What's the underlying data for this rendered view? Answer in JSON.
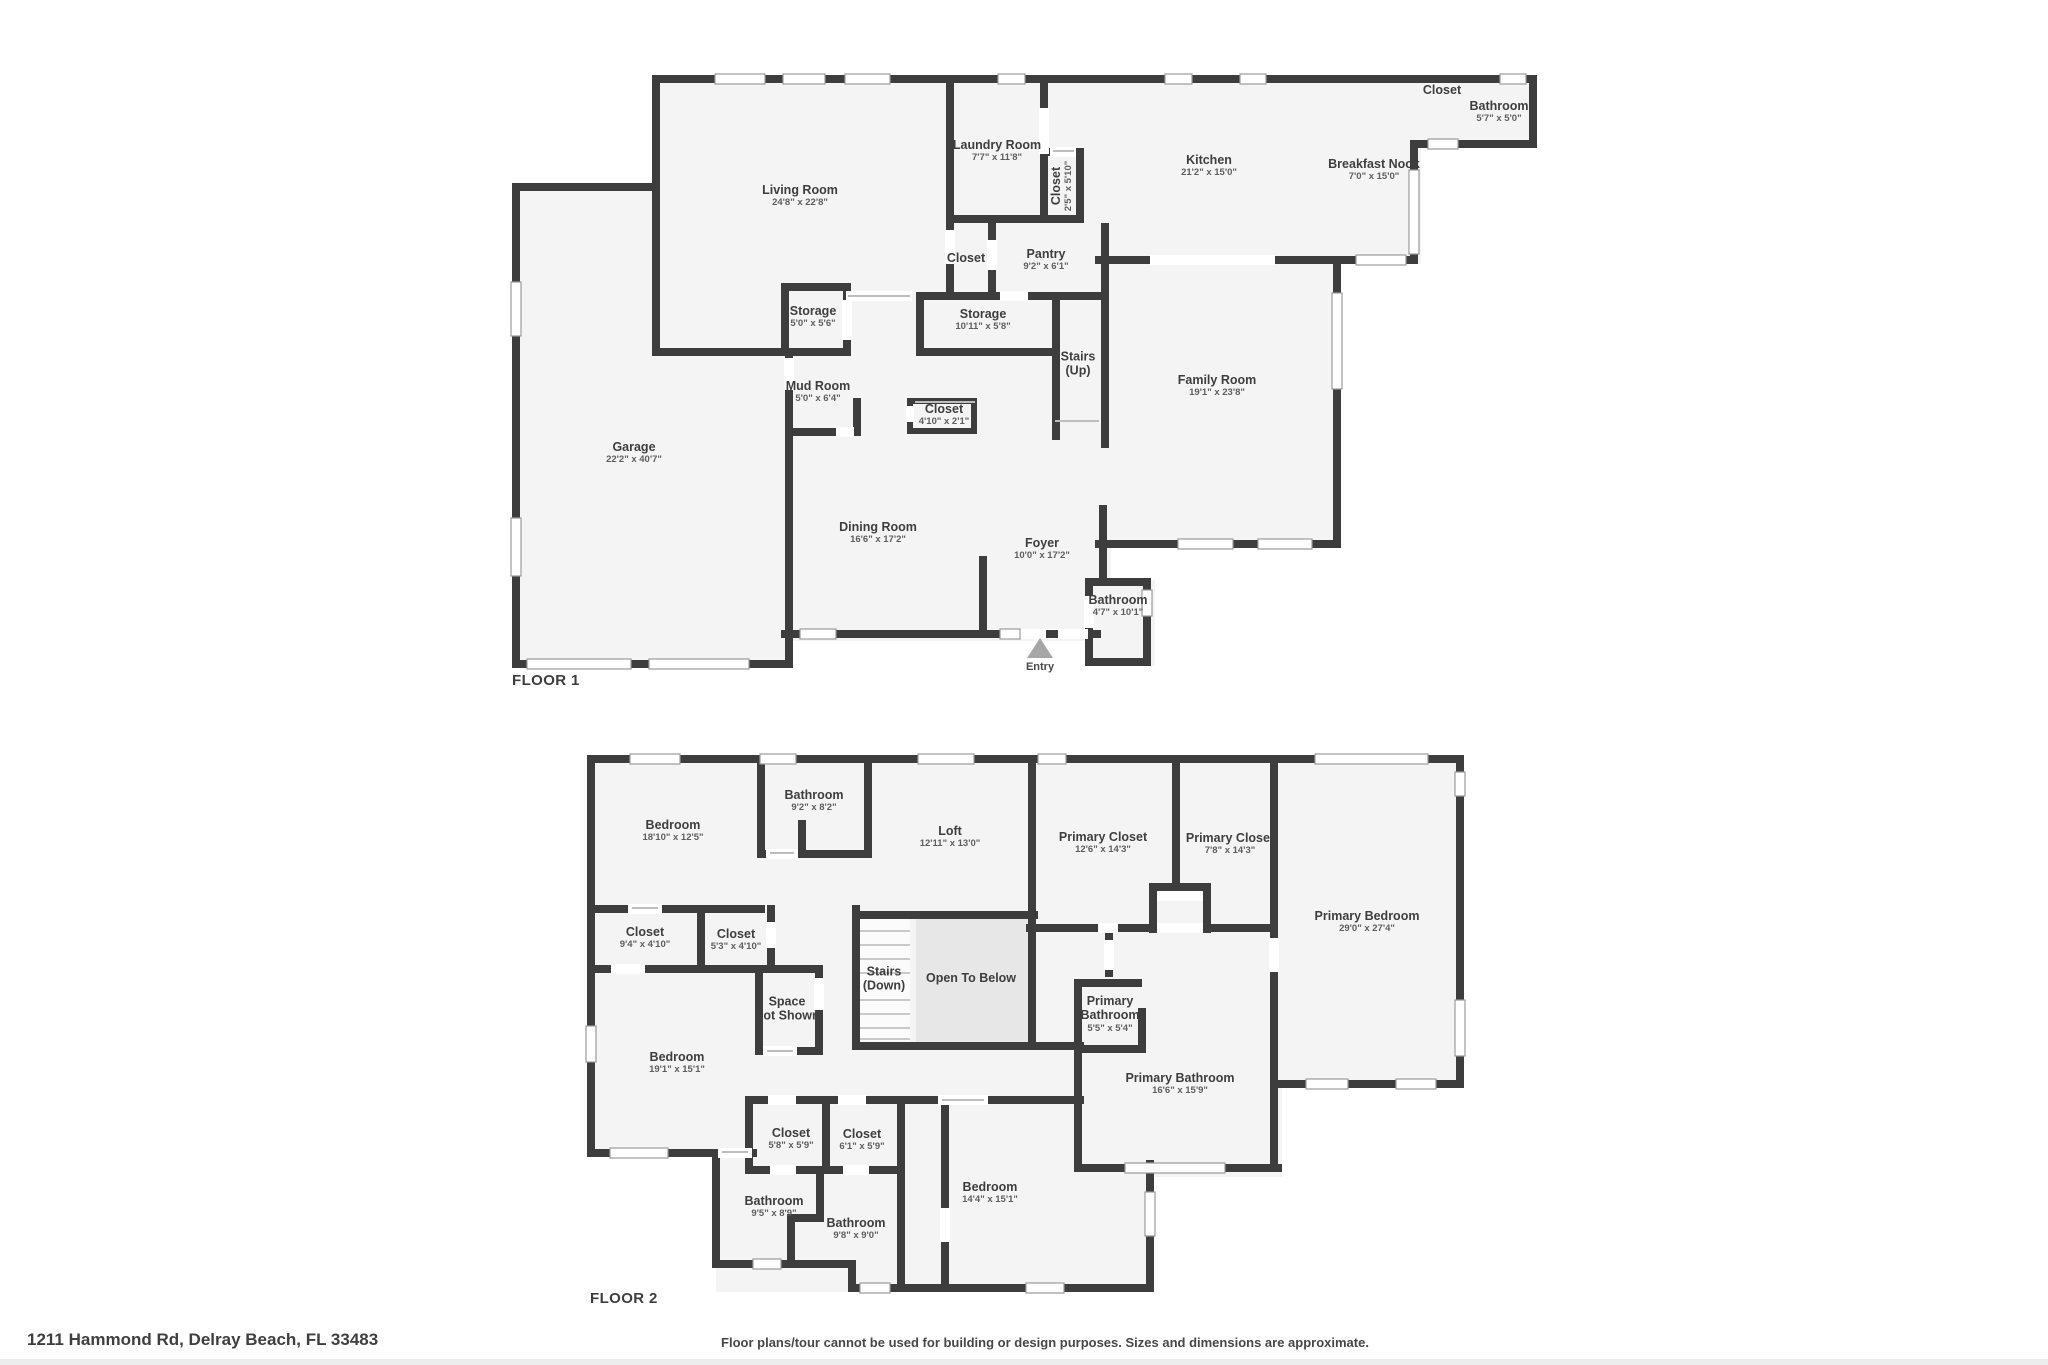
{
  "floor1": {
    "label": "FLOOR 1",
    "entry_label": "Entry",
    "rooms": [
      {
        "name": "Living Room",
        "dims": "24'8\" x 22'8\""
      },
      {
        "name": "Laundry Room",
        "dims": "7'7\" x 11'8\""
      },
      {
        "name": "Closet",
        "dims": "2'5\" x 5'10\""
      },
      {
        "name": "Closet",
        "dims": ""
      },
      {
        "name": "Pantry",
        "dims": "9'2\" x 6'1\""
      },
      {
        "name": "Kitchen",
        "dims": "21'2\" x 15'0\""
      },
      {
        "name": "Breakfast Nook",
        "dims": "7'0\" x 15'0\""
      },
      {
        "name": "Closet",
        "dims": ""
      },
      {
        "name": "Bathroom",
        "dims": "5'7\" x 5'0\""
      },
      {
        "name": "Storage",
        "dims": "5'0\" x 5'6\""
      },
      {
        "name": "Storage",
        "dims": "10'11\" x 5'8\""
      },
      {
        "name": "Stairs\n(Up)",
        "dims": ""
      },
      {
        "name": "Mud Room",
        "dims": "5'0\" x 6'4\""
      },
      {
        "name": "Closet",
        "dims": "4'10\" x 2'1\""
      },
      {
        "name": "Garage",
        "dims": "22'2\" x 40'7\""
      },
      {
        "name": "Dining Room",
        "dims": "16'6\" x 17'2\""
      },
      {
        "name": "Family Room",
        "dims": "19'1\" x 23'8\""
      },
      {
        "name": "Foyer",
        "dims": "10'0\" x 17'2\""
      },
      {
        "name": "Bathroom",
        "dims": "4'7\" x 10'1\""
      }
    ]
  },
  "floor2": {
    "label": "FLOOR 2",
    "rooms": [
      {
        "name": "Bedroom",
        "dims": "18'10\" x 12'5\""
      },
      {
        "name": "Bathroom",
        "dims": "9'2\" x 8'2\""
      },
      {
        "name": "Loft",
        "dims": "12'11\" x 13'0\""
      },
      {
        "name": "Primary Closet",
        "dims": "12'6\" x 14'3\""
      },
      {
        "name": "Primary Closet",
        "dims": "7'8\" x 14'3\""
      },
      {
        "name": "Primary Bedroom",
        "dims": "29'0\" x 27'4\""
      },
      {
        "name": "Closet",
        "dims": "9'4\" x 4'10\""
      },
      {
        "name": "Closet",
        "dims": "5'3\" x 4'10\""
      },
      {
        "name": "Space\nNot Shown",
        "dims": ""
      },
      {
        "name": "Stairs\n(Down)",
        "dims": ""
      },
      {
        "name": "Open To Below",
        "dims": ""
      },
      {
        "name": "Primary\nBathroom",
        "dims": "5'5\" x 5'4\""
      },
      {
        "name": "Primary Bathroom",
        "dims": "16'6\" x 15'9\""
      },
      {
        "name": "Bedroom",
        "dims": "19'1\" x 15'1\""
      },
      {
        "name": "Closet",
        "dims": "5'8\" x 5'9\""
      },
      {
        "name": "Closet",
        "dims": "6'1\" x 5'9\""
      },
      {
        "name": "Bathroom",
        "dims": "9'5\" x 8'9\""
      },
      {
        "name": "Bathroom",
        "dims": "9'8\" x 9'0\""
      },
      {
        "name": "Bedroom",
        "dims": "14'4\" x 15'1\""
      }
    ]
  },
  "footer": {
    "address": "1211 Hammond Rd, Delray Beach, FL 33483",
    "disclaimer": "Floor plans/tour cannot be used for building or design purposes. Sizes and dimensions are approximate."
  },
  "colors": {
    "wall": "#3d3d3d",
    "room_fill": "#f4f4f4",
    "open_to_below_fill": "#e7e7e7",
    "window_stroke": "#9b9b9b",
    "entry_marker": "#a6a6a6"
  }
}
